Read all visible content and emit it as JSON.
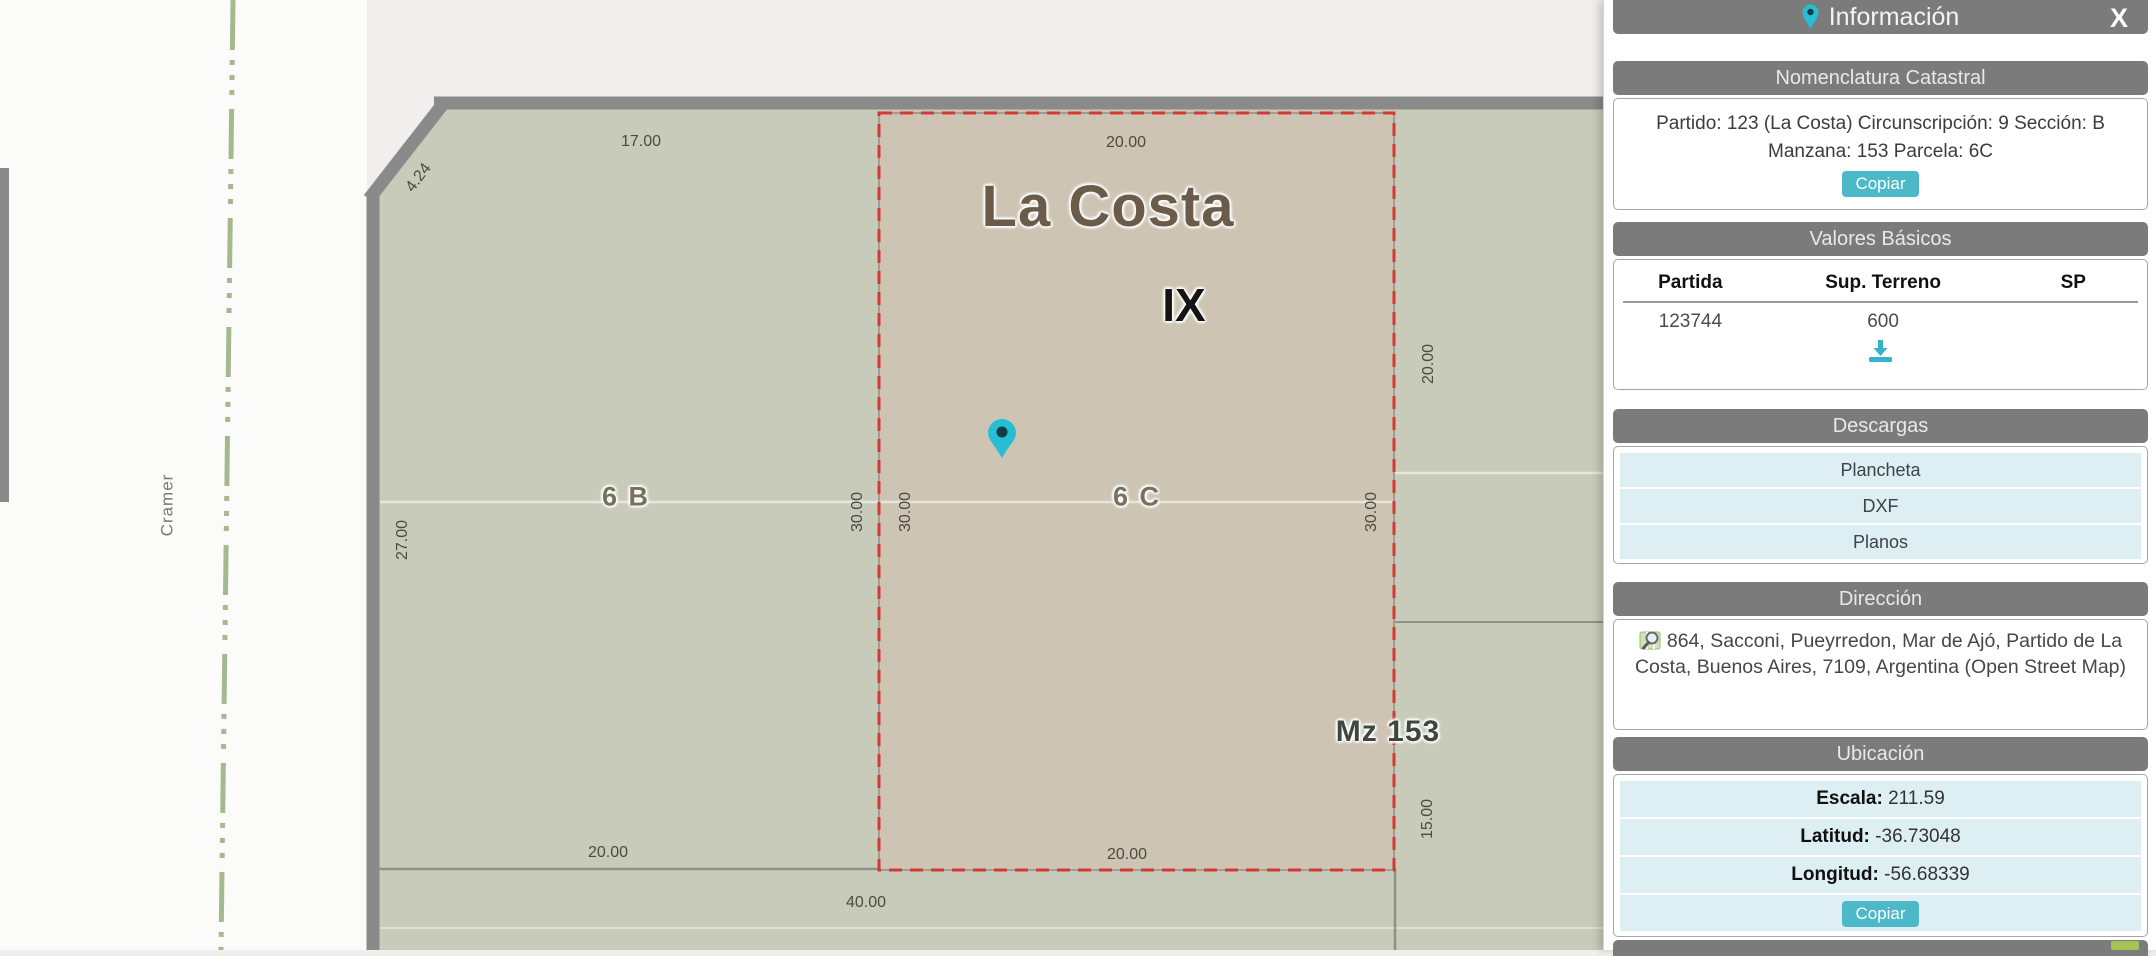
{
  "panel": {
    "title": "Información",
    "close_label": "X",
    "sections": {
      "nomenclatura": {
        "header": "Nomenclatura Catastral",
        "line1": "Partido: 123 (La Costa) Circunscripción: 9 Sección: B",
        "line2": "Manzana: 153 Parcela: 6C",
        "copy_label": "Copiar"
      },
      "valores": {
        "header": "Valores Básicos",
        "col_partida": "Partida",
        "col_sup_terreno": "Sup. Terreno",
        "col_sp": "SP",
        "row_partida": "123744",
        "row_sup_terreno": "600",
        "row_sp": ""
      },
      "descargas": {
        "header": "Descargas",
        "item1": "Plancheta",
        "item2": "DXF",
        "item3": "Planos"
      },
      "direccion": {
        "header": "Dirección",
        "text": "864, Sacconi, Pueyrredon, Mar de Ajó, Partido de La Costa, Buenos Aires, 7109, Argentina (Open Street Map)"
      },
      "ubicacion": {
        "header": "Ubicación",
        "escala_label": "Escala:",
        "escala_value": "211.59",
        "latitud_label": "Latitud:",
        "latitud_value": "-36.73048",
        "longitud_label": "Longitud:",
        "longitud_value": "-56.68339",
        "copy_label": "Copiar"
      }
    }
  },
  "map": {
    "street_name": "Cramer",
    "city_label": "La Costa",
    "section_label": "IX",
    "block_label": "Mz 153",
    "parcel_left_label": "6 B",
    "parcel_selected_label": "6 C",
    "dim_top_left": "17.00",
    "dim_bevel": "4.24",
    "dim_top_selected": "20.00",
    "dim_right_upper": "20.00",
    "dim_left": "27.00",
    "dim_divider_left": "30.00",
    "dim_divider_right": "30.00",
    "dim_selected_right": "30.00",
    "dim_bottom_left": "20.00",
    "dim_bottom_selected": "20.00",
    "dim_right_lower": "15.00",
    "dim_below_block": "40.00"
  },
  "colors": {
    "accent_teal": "#4cb8c8",
    "pin_teal": "#27bdd3",
    "block_fill": "#c8cbb9",
    "selected_parcel_fill": "#cdc4b3",
    "selection_border_red": "#d23b35",
    "panel_header_gray": "#7b7b7b",
    "row_light_blue": "#ddeff3",
    "road_casing_gray": "#8a8a8a",
    "street_centerline_green": "#a5b98f"
  }
}
